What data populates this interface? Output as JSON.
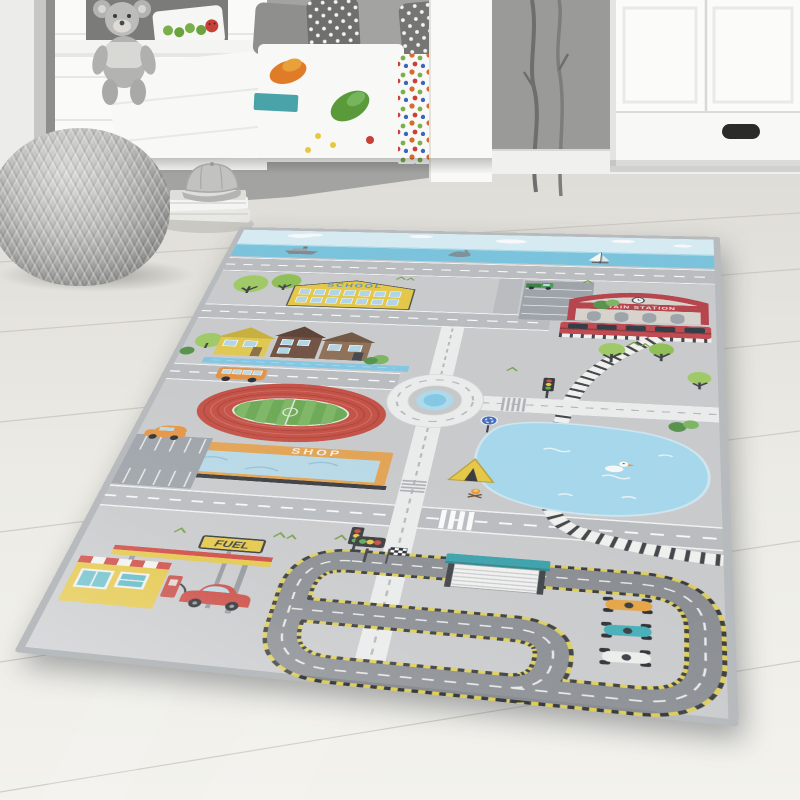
{
  "scene": {
    "type": "product photograph",
    "setting": "children's room with white cabin bed, wardrobe, gray knitted pouf, teddy bear, stacked books with a cap",
    "subject": "city traffic play rug in gray"
  },
  "rug": {
    "labels": {
      "school": "SCHOOL",
      "train_station": "TRAIN STATION",
      "shop": "SHOP",
      "fuel": "FUEL",
      "parking": "P"
    },
    "palette": {
      "rug_base": "#cacbcd",
      "binding": "#b6babd",
      "road_gray": "#b9bcc0",
      "road_white": "#eef0ef",
      "sky": "#d8eef6",
      "sea": "#74c3de",
      "lake": "#a4d9ef",
      "school_yellow": "#e7c83f",
      "station_red": "#b53a42",
      "shop_orange": "#e5a14b",
      "stadium_track_red": "#c4483c",
      "pitch_green": "#67a84e",
      "tree_green": "#9cca5e",
      "bus_orange": "#e58f3c",
      "car_red": "#cc4038",
      "race_car_teal": "#39acb8",
      "curb_yellow": "#e0ce52",
      "asphalt": "#84888d",
      "pit_roof_teal": "#2f9ea8",
      "sign_blue": "#3a66c0"
    },
    "features": [
      "sky with clouds",
      "sea with ship, dolphin and sailboat",
      "school building",
      "train station with red train",
      "railway line around a lake",
      "row of houses",
      "canal",
      "roundabout with blue fountain",
      "stadium with running track and pitch",
      "shop with glass front",
      "two parking lots",
      "orange bus",
      "orange car",
      "gas station with pump and red car",
      "campsite tent with campfire",
      "race circuit with start lights, checkered flag, pit garage and three race cars",
      "traffic lights",
      "trees and bushes",
      "duck on the lake"
    ]
  }
}
